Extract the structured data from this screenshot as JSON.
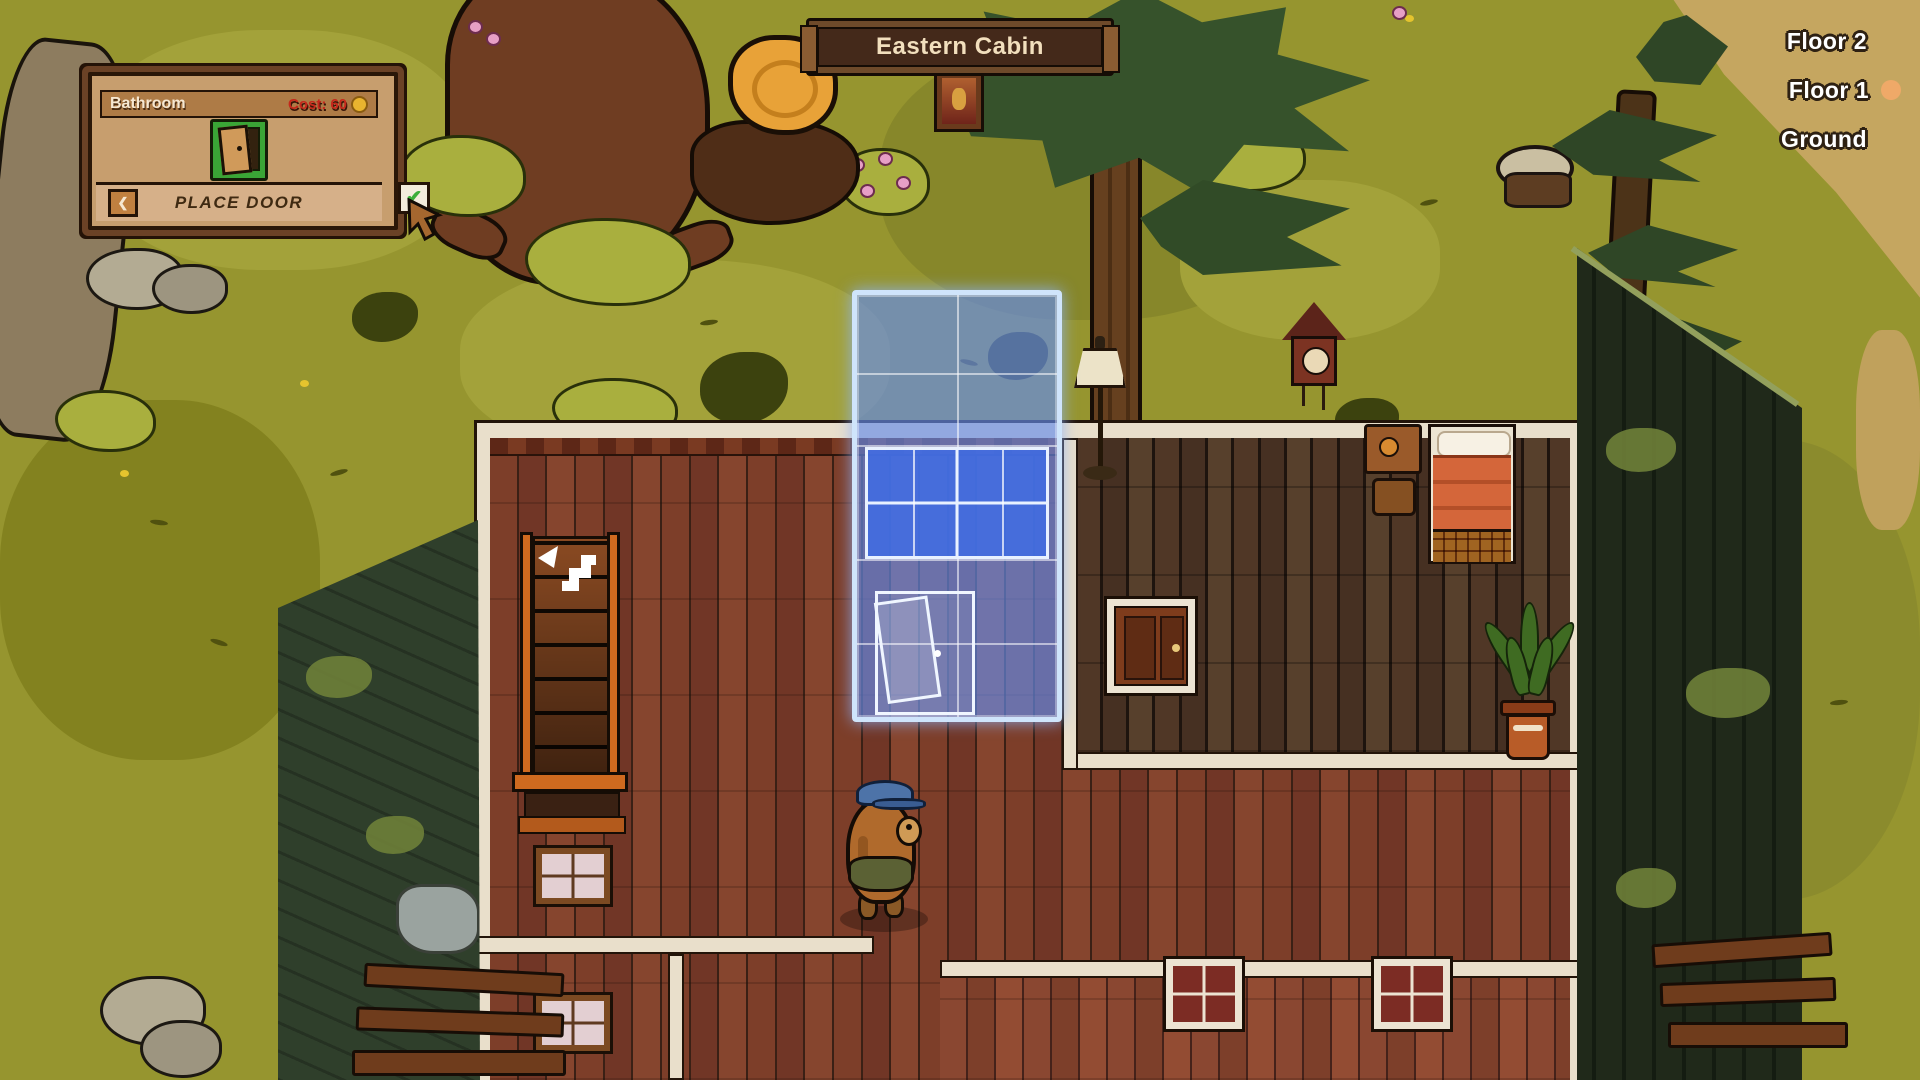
{
  "hud": {
    "location_banner": {
      "title": "Eastern Cabin"
    },
    "placement_panel": {
      "title": "Bathroom",
      "cost_label": "Cost:",
      "cost_value": "60",
      "action_label": "PLACE DOOR",
      "back_chevron_glyph": "❮",
      "confirm_check_glyph": "✔"
    },
    "floor_selector": {
      "floors": [
        {
          "label": "Floor 2",
          "active": false
        },
        {
          "label": "Floor 1",
          "active": true
        },
        {
          "label": "Ground",
          "active": false
        }
      ]
    }
  },
  "palette": {
    "grass": "#96952f",
    "placement_highlight": "#5f8fe8",
    "placement_border": "#cfe4fb",
    "cost_red": "#c6271b",
    "active_floor_dot": "#efa968",
    "panel_wood": "#c79e6e",
    "banner_wood": "#44291a",
    "floor_left_room": "#7b3c28",
    "floor_right_room": "#4e3526",
    "wall": "#e9dfcb"
  }
}
